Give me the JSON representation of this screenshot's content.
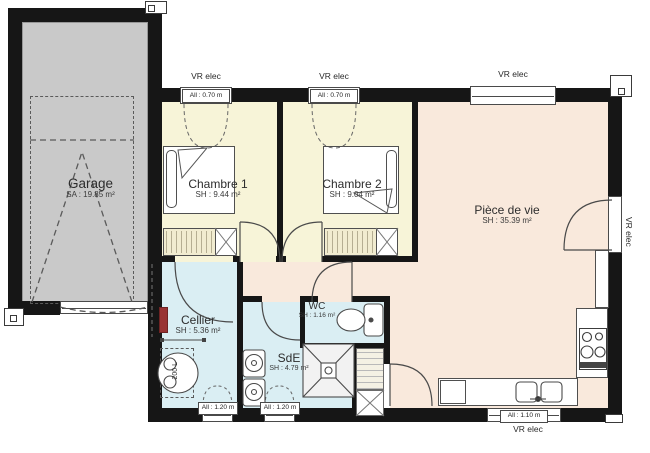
{
  "plan": {
    "rooms": {
      "garage": {
        "name": "Garage",
        "area": "SA : 19.85 m²"
      },
      "chambre1": {
        "name": "Chambre 1",
        "area": "SH : 9.44 m²"
      },
      "chambre2": {
        "name": "Chambre 2",
        "area": "SH : 9.04 m²"
      },
      "piece_de_vie": {
        "name": "Pièce de vie",
        "area": "SH : 35.39 m²"
      },
      "cellier": {
        "name": "Cellier",
        "area": "SH : 5.36 m²"
      },
      "wc": {
        "name": "WC",
        "area": "SH : 1.16 m²"
      },
      "sde": {
        "name": "SdE",
        "area": "SH : 4.79 m²"
      }
    },
    "annotations": {
      "shutter": "VR elec",
      "sill_070": "All : 0.70 m",
      "sill_110": "All : 1.10 m",
      "sill_120": "All : 1.20 m",
      "water_heater": "200 L"
    },
    "colors": {
      "wall": "#161616",
      "garage_fill": "#c9c9c9",
      "bedroom_fill": "#f7f4d8",
      "living_fill": "#f9e9dc",
      "wet_fill": "#daeef3",
      "line": "#4a4a4a"
    }
  }
}
